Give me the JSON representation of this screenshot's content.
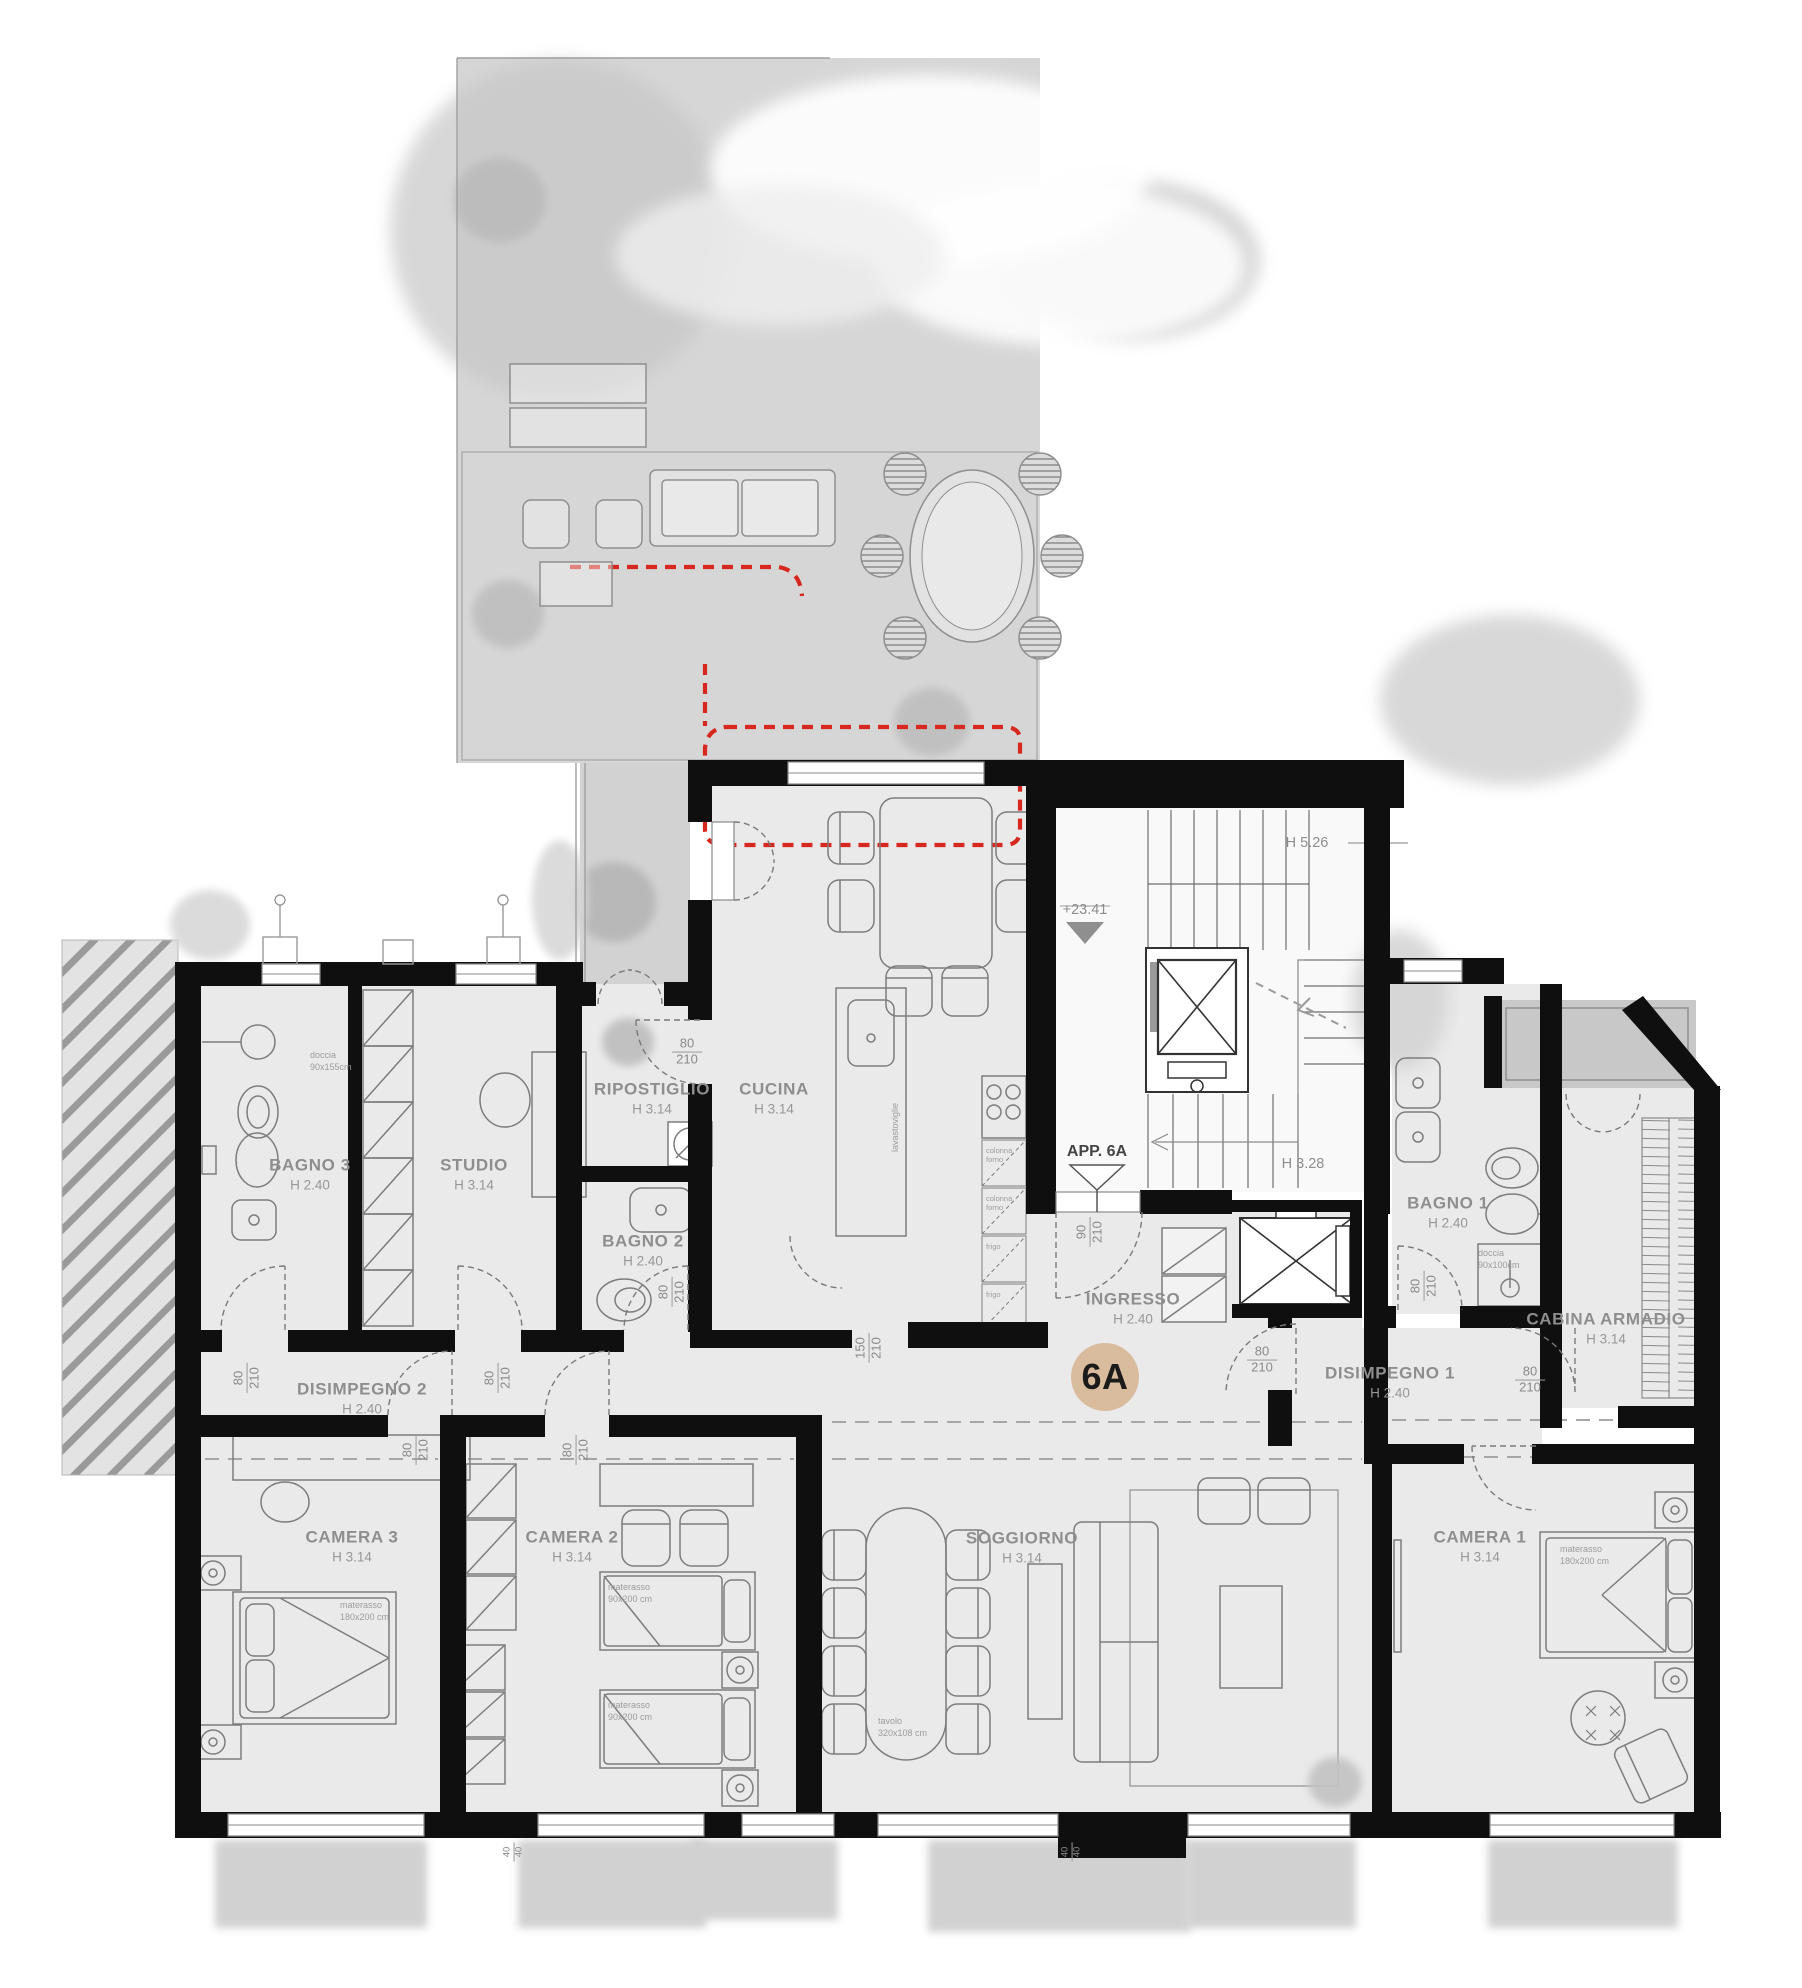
{
  "badge": {
    "label": "6A",
    "color": "#d9bc9e"
  },
  "markers": {
    "apartment_entry": "APP. 6A",
    "elevation": "+23.41",
    "stair_height_upper": "H 5.26",
    "stair_height_lower": "H 3.28"
  },
  "rooms": {
    "bagno3": {
      "name": "BAGNO 3",
      "height": "H 2.40"
    },
    "studio": {
      "name": "STUDIO",
      "height": "H 3.14"
    },
    "ripostiglio": {
      "name": "RIPOSTIGLIO",
      "height": "H 3.14"
    },
    "cucina": {
      "name": "CUCINA",
      "height": "H 3.14"
    },
    "bagno2": {
      "name": "BAGNO 2",
      "height": "H 2.40"
    },
    "disimpegno2": {
      "name": "DISIMPEGNO 2",
      "height": "H 2.40"
    },
    "camera3": {
      "name": "CAMERA 3",
      "height": "H 3.14"
    },
    "camera2": {
      "name": "CAMERA 2",
      "height": "H 3.14"
    },
    "soggiorno": {
      "name": "SOGGIORNO",
      "height": "H 3.14"
    },
    "ingresso": {
      "name": "INGRESSO",
      "height": "H 2.40"
    },
    "disimpegno1": {
      "name": "DISIMPEGNO 1",
      "height": "H 2.40"
    },
    "bagno1": {
      "name": "BAGNO 1",
      "height": "H 2.40"
    },
    "cabina": {
      "name": "CABINA ARMADIO",
      "height": "H 3.14"
    },
    "camera1": {
      "name": "CAMERA 1",
      "height": "H 3.14"
    }
  },
  "dims": {
    "door_w": "80",
    "door_h": "210",
    "entry_w": "90",
    "kitchen_opening_w": "150",
    "sill": "40"
  },
  "fixtures": {
    "shower_bagno3": {
      "label": "doccia",
      "size": "90x155cm"
    },
    "shower_bagno1": {
      "label": "doccia",
      "size": "90x100cm"
    },
    "mattress_double": {
      "label": "materasso",
      "size": "180x200 cm"
    },
    "mattress_single": {
      "label": "materasso",
      "size": "90x200 cm"
    },
    "dining_table": {
      "label": "tavolo",
      "size": "320x108 cm"
    },
    "dishwasher": "lavastoviglie",
    "oven_column": {
      "l1": "colonna",
      "l2": "forno"
    },
    "fridge": "frigo"
  },
  "colors": {
    "wall": "#0f0f0f",
    "room_fill": "#eaeaea",
    "terrace_fill": "#d6d6d6",
    "canopy_line": "#d6281e",
    "badge": "#d9bc9e"
  }
}
